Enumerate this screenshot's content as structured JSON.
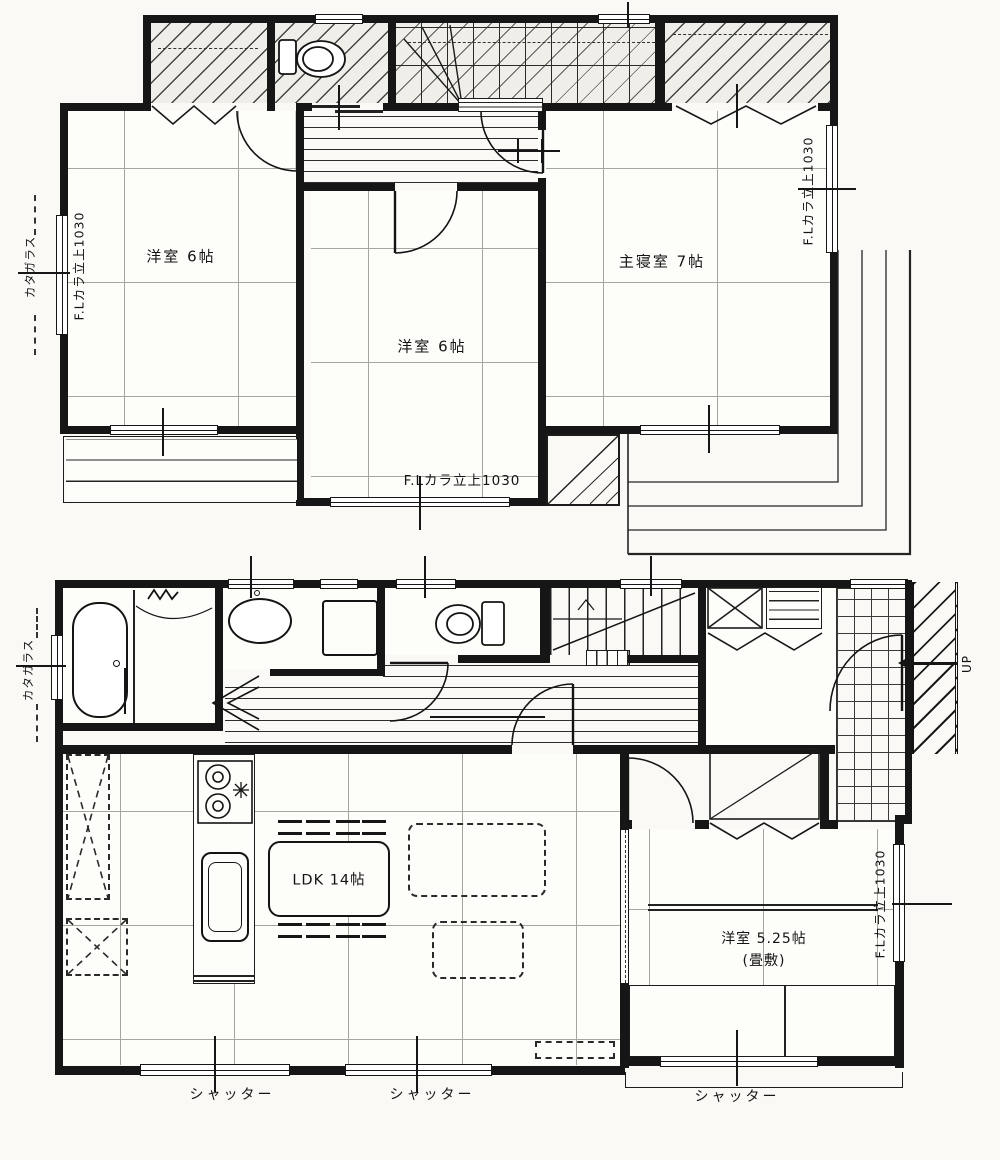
{
  "plan": {
    "f2": {
      "room_left": "洋室 6帖",
      "room_center": "洋室 6帖",
      "room_master": "主寝室 7帖",
      "sill_left": "F.Lカラ立上1030",
      "sill_right": "F.Lカラ立上1030",
      "sill_bottom": "F.Lカラ立上1030",
      "glass_left": "カタガラス"
    },
    "f1": {
      "room_ldk": "LDK 14帖",
      "room_tatami": "洋室 5.25帖",
      "room_tatami_note": "(畳敷)",
      "sill_right": "F.Lカラ立上1030",
      "glass_left": "カタガラス",
      "up_label": "UP",
      "shutters": [
        "シャッター",
        "シャッター",
        "シャッター"
      ]
    },
    "colors": {
      "wall": "#161616",
      "paper": "#faf9f5"
    }
  }
}
